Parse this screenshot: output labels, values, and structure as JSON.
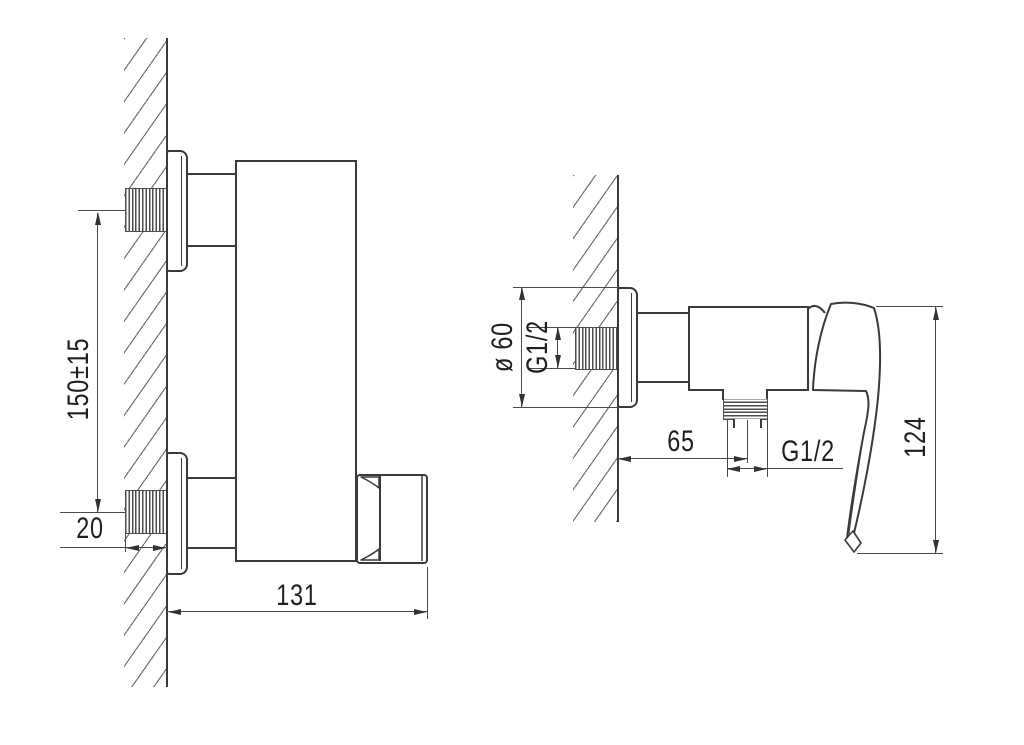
{
  "drawing": {
    "dimensions": {
      "center_distance": "150±15",
      "wall_thickness": "20",
      "body_width": "131",
      "escutcheon_diameter": "ø 60",
      "inlet_thread": "G1/2",
      "outlet_offset": "65",
      "outlet_thread": "G1/2",
      "handle_height": "124"
    },
    "colors": {
      "background": "#ffffff",
      "object_line": "#3a3a3a",
      "dimension_line": "#4a4a4a",
      "hatch": "#737373",
      "text": "#1f1f1f"
    }
  }
}
